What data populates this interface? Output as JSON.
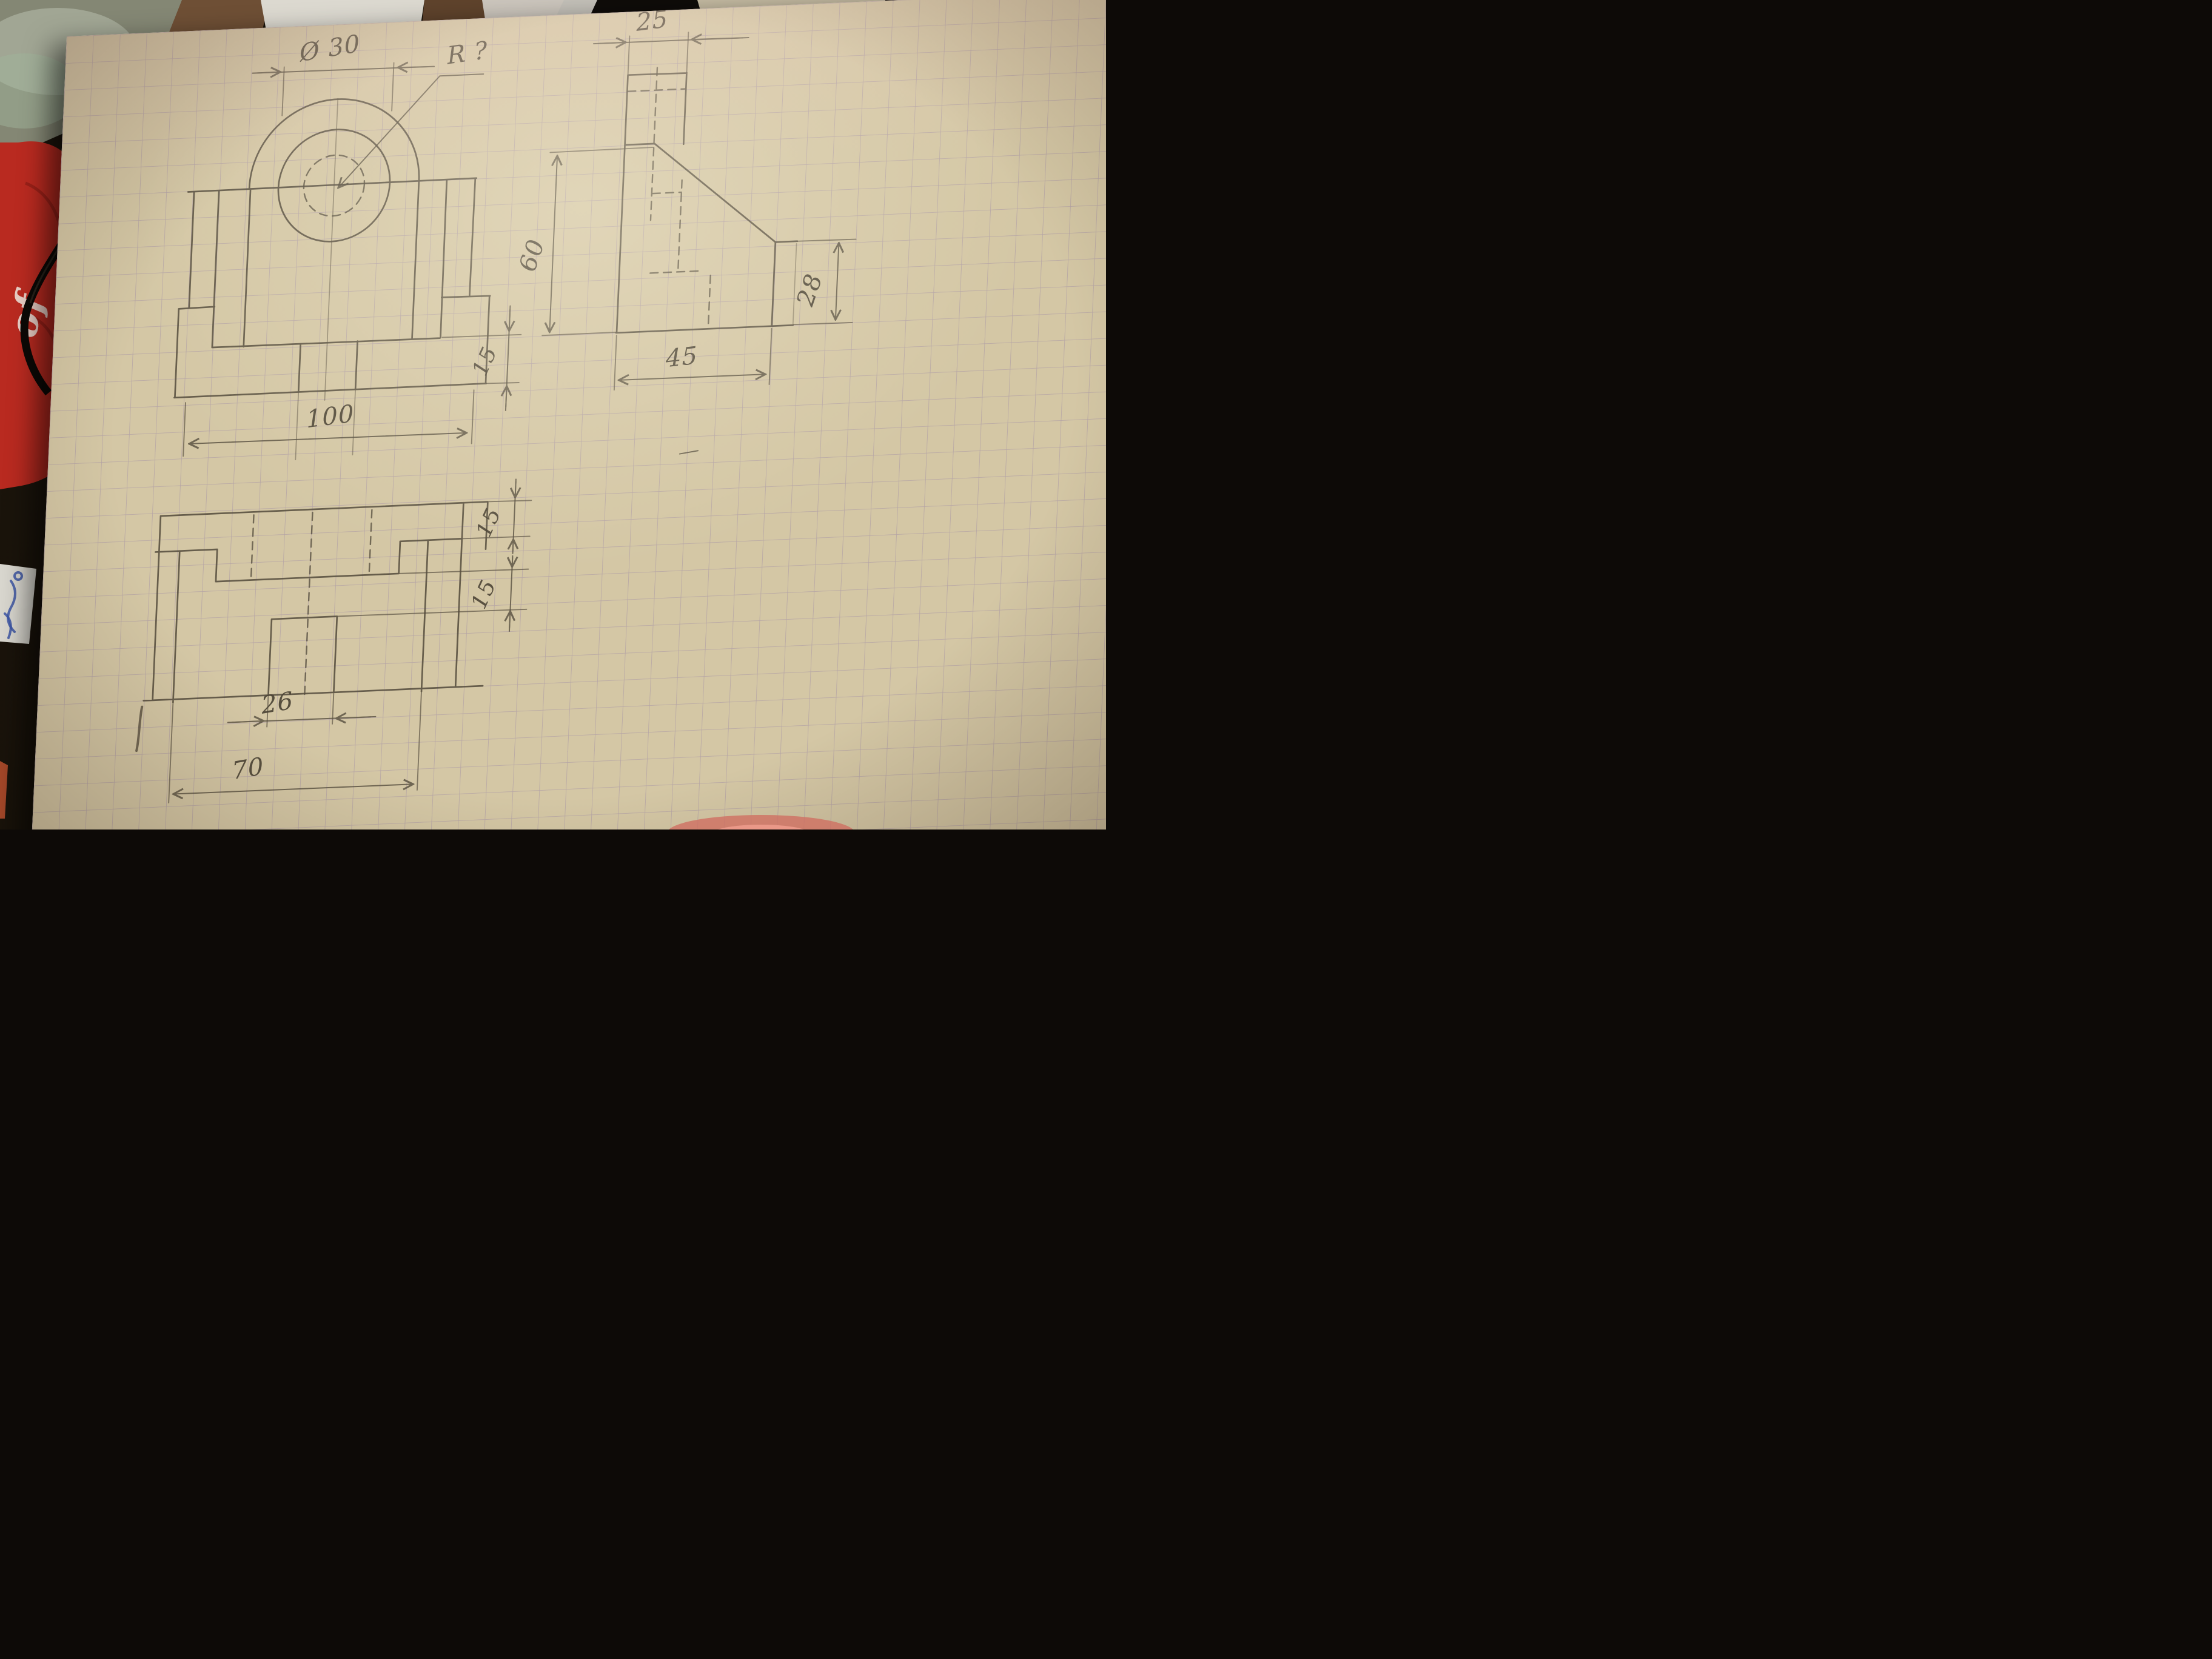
{
  "drawing": {
    "front_view": {
      "name": "front view of bracket",
      "labels": {
        "diameter": "Ø 30",
        "radius_unknown": "R ?",
        "overall_width": "100",
        "base_thickness": "15"
      }
    },
    "side_view": {
      "name": "side view of bracket",
      "labels": {
        "top_width": "25",
        "height": "60",
        "step_height": "28",
        "base_depth": "45"
      }
    },
    "top_view": {
      "name": "top view of bracket",
      "labels": {
        "edge_band": "15",
        "slot_offset": "15",
        "slot_width": "26",
        "length": "70"
      }
    },
    "colors": {
      "paper": "#d4c7a5",
      "grid_line": "#ac9ba5",
      "pencil": "#564e3f",
      "red_object": "#b92a20",
      "desk_dark": "#16110d",
      "ink_scribbles": "#3c56a5"
    }
  },
  "desk": {
    "red_object_text": "of"
  }
}
